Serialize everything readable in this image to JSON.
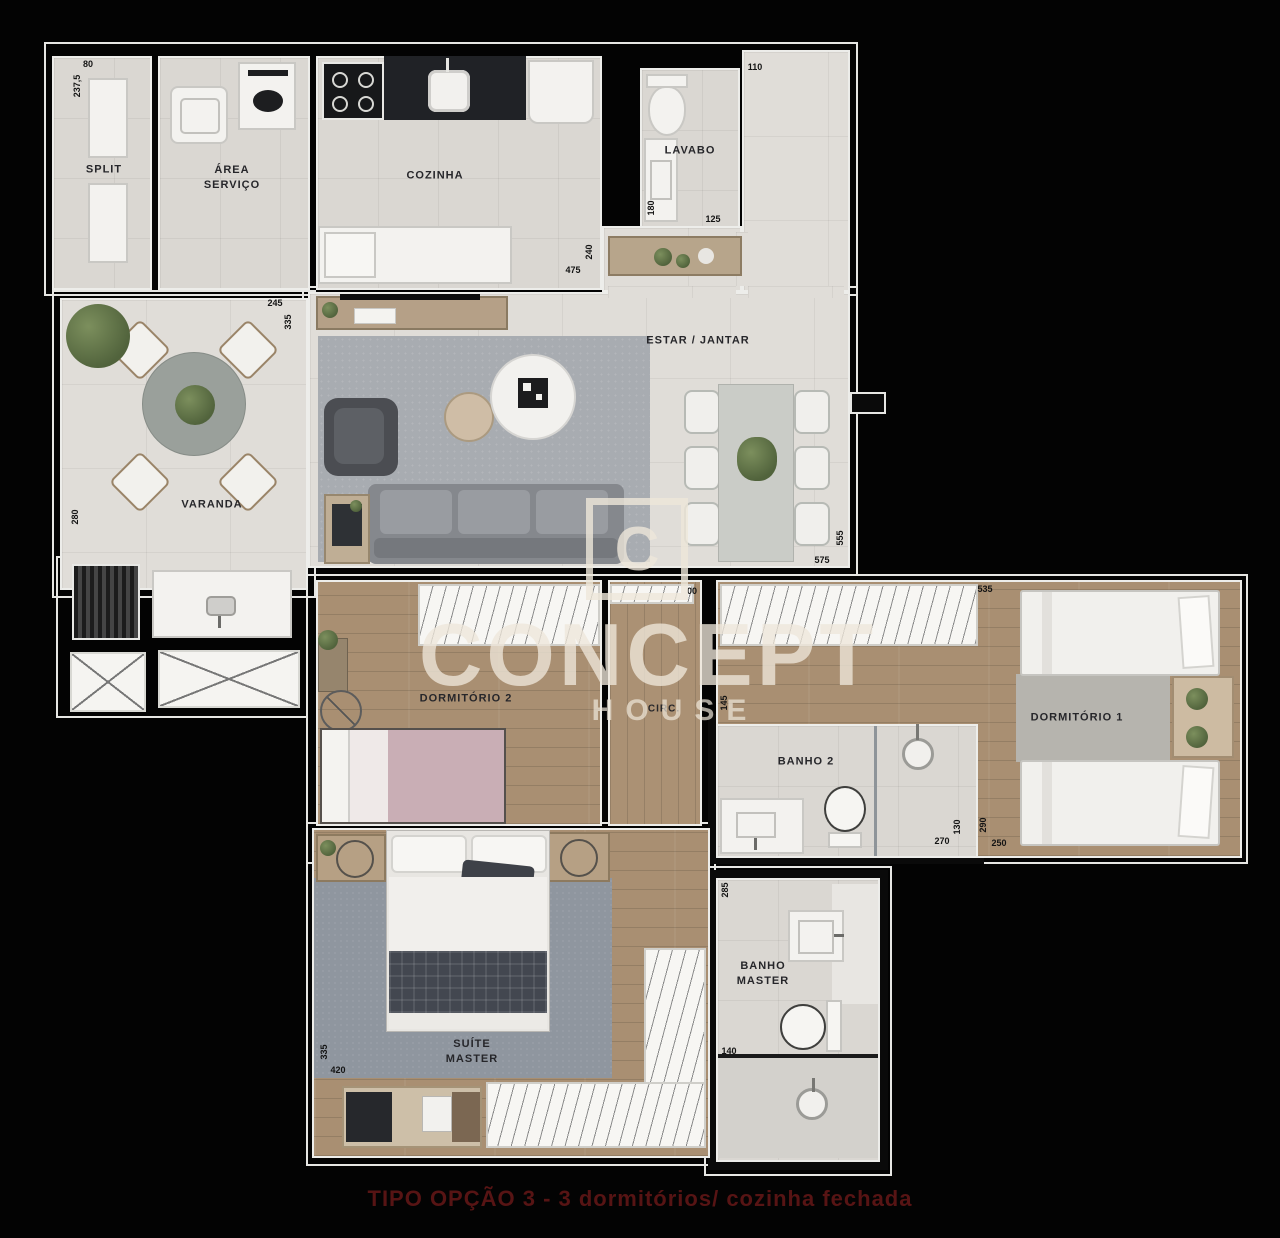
{
  "watermark": {
    "brand_top": "CONCEPT",
    "brand_bottom": "HOUSE",
    "logo_letter": "C"
  },
  "caption": "TIPO OPÇÃO 3 - 3 dormitórios/ cozinha fechada",
  "rooms": {
    "split": {
      "label": "SPLIT"
    },
    "area_servico": {
      "line1": "ÁREA",
      "line2": "SERVIÇO"
    },
    "cozinha": {
      "label": "COZINHA"
    },
    "lavabo": {
      "label": "LAVABO"
    },
    "varanda": {
      "label": "VARANDA"
    },
    "estar_jantar": {
      "label": "ESTAR / JANTAR"
    },
    "dormitorio2": {
      "label": "DORMITÓRIO 2"
    },
    "circ": {
      "label": "CIRC."
    },
    "banho2": {
      "label": "BANHO 2"
    },
    "dormitorio1": {
      "label": "DORMITÓRIO 1"
    },
    "suite_master": {
      "line1": "SUÍTE",
      "line2": "MASTER"
    },
    "banho_master": {
      "line1": "BANHO",
      "line2": "MASTER"
    }
  },
  "dims": {
    "d1": "80",
    "d2": "237,5",
    "d3": "475",
    "d4": "240",
    "d5": "110",
    "d6": "180",
    "d7": "125",
    "d8": "245",
    "d9": "335",
    "d10": "280",
    "d11": "555",
    "d12": "575",
    "d13": "00",
    "d14": "535",
    "d15": "145",
    "d16": "270",
    "d17": "130",
    "d18": "290",
    "d19": "250",
    "d20": "335",
    "d21": "420",
    "d22": "285",
    "d23": "140"
  },
  "colors": {
    "background": "#000000",
    "wall_outline": "#ebebeb",
    "floor_tile": "#e0ddd8",
    "floor_wood": "#a98f72",
    "rug": "#8f969f",
    "caption_text": "#571414"
  }
}
